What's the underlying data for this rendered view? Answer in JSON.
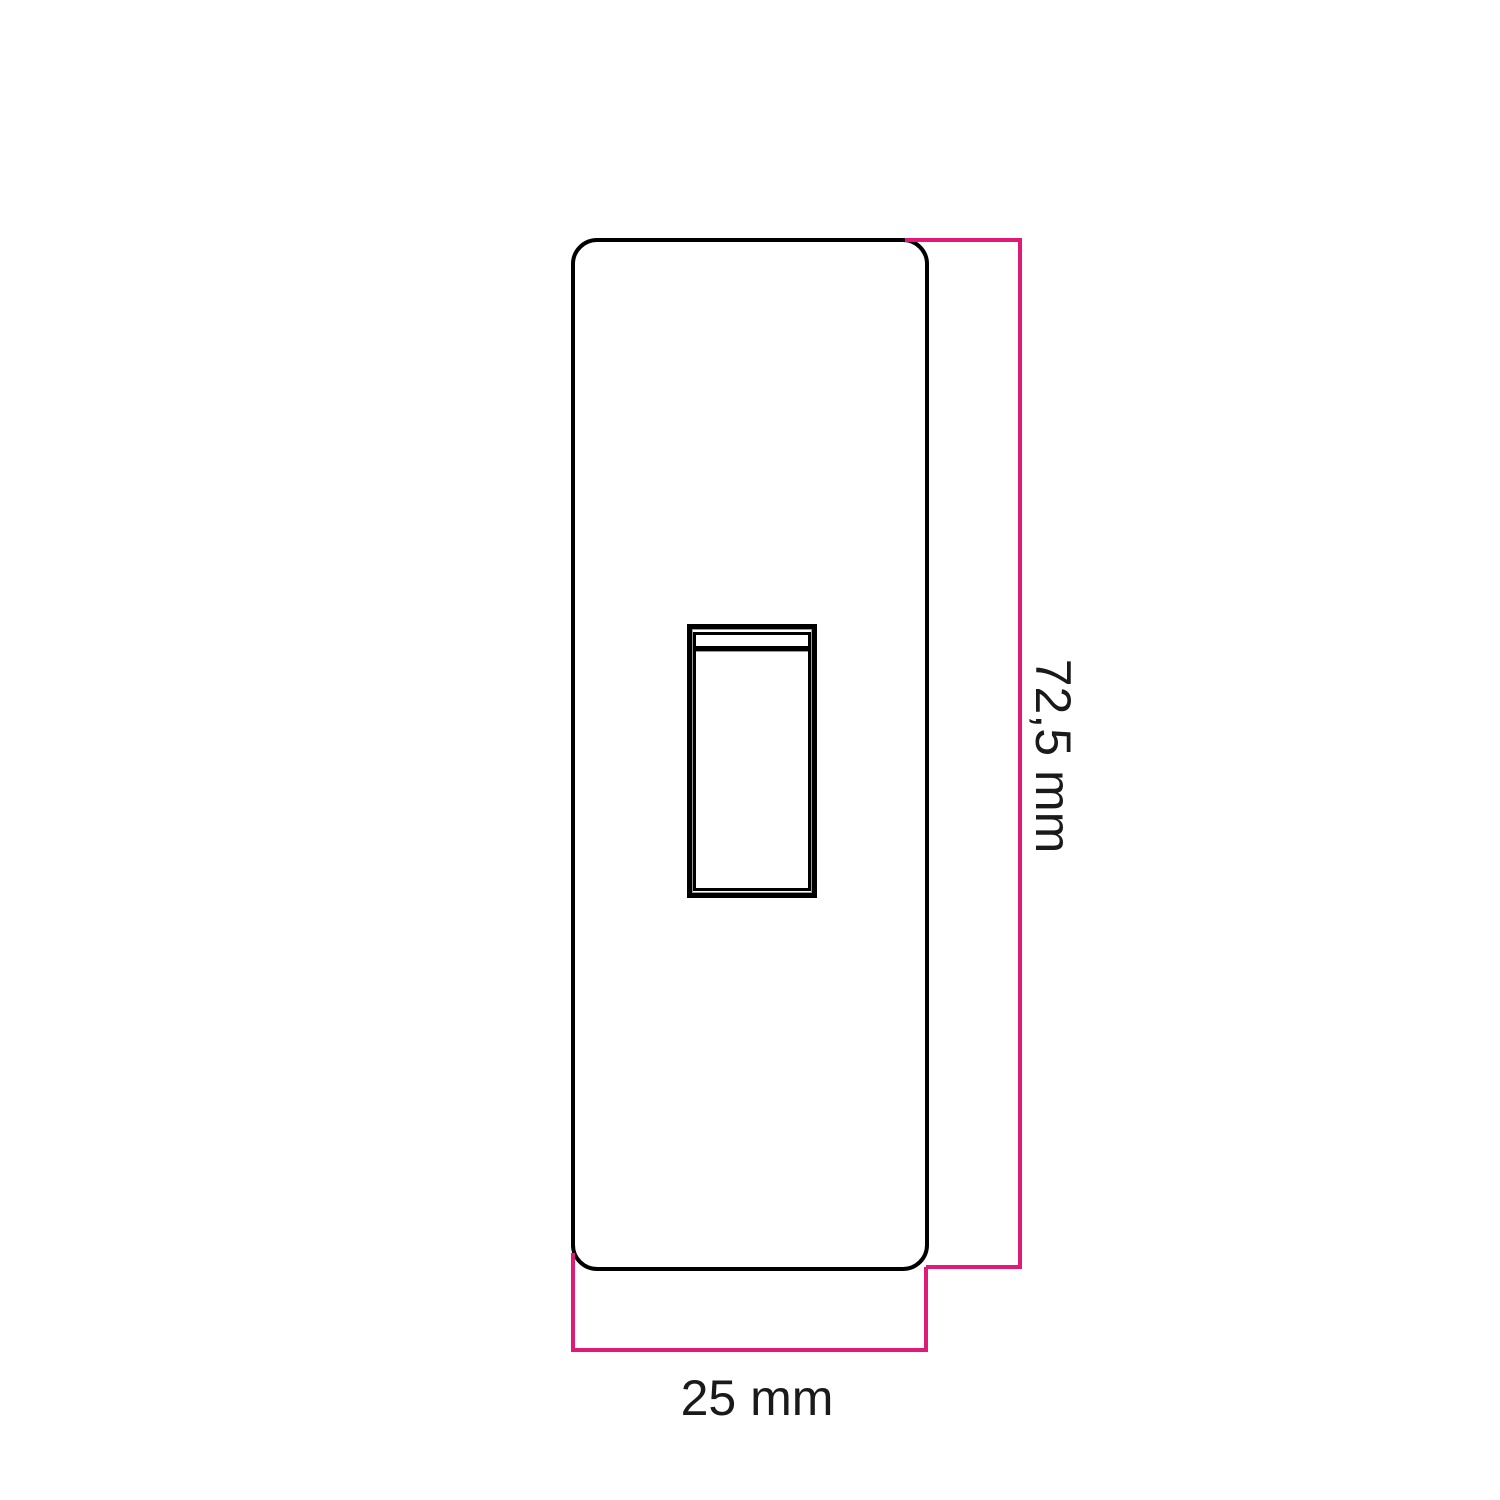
{
  "drawing": {
    "type": "technical-dimension-drawing",
    "view": "switch-plate-front-view",
    "height_dimension": {
      "label": "72,5 mm"
    },
    "width_dimension": {
      "label": "25 mm"
    }
  },
  "colors": {
    "dimension_line": "#e11a77",
    "outline": "#000000",
    "text": "#1a1a1a",
    "background": "#ffffff"
  }
}
